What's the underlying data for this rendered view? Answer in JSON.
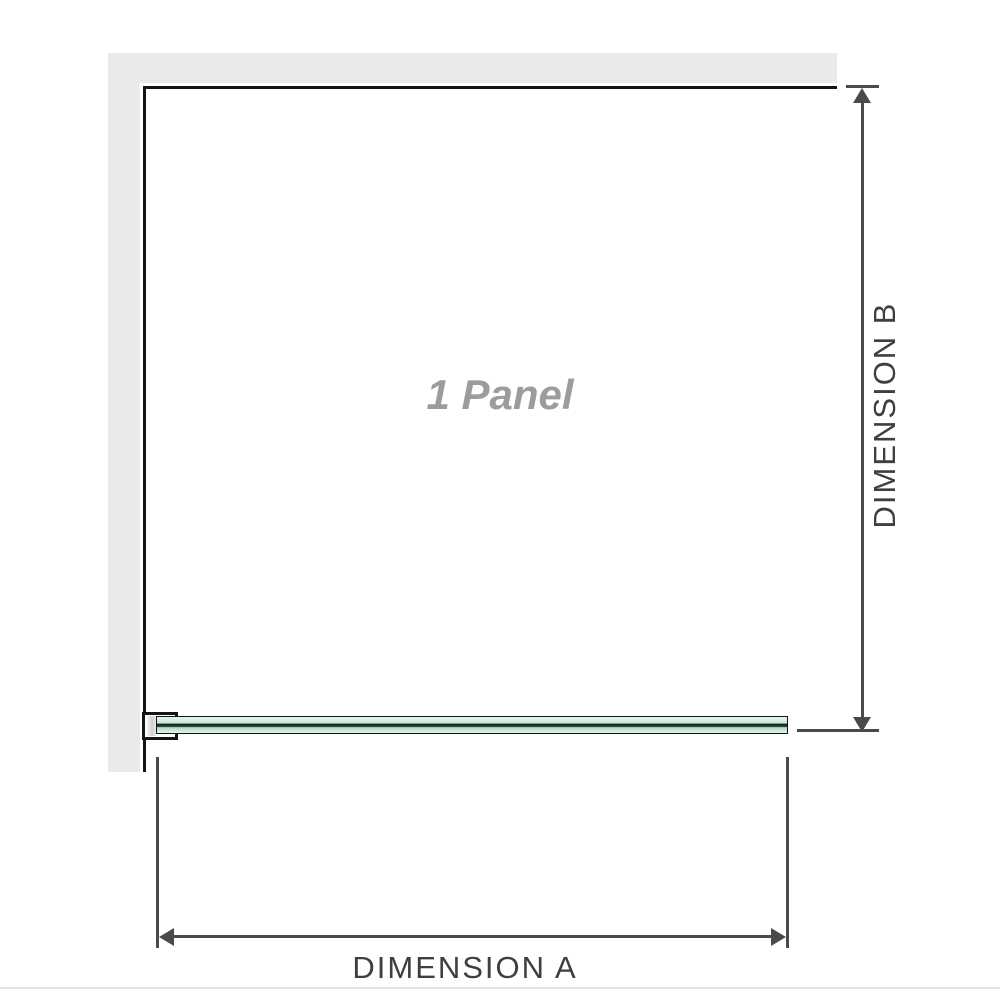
{
  "diagram": {
    "title": "shower screen single panel installation diagram (plan view)",
    "panel_label": "1 Panel",
    "dimension_a": {
      "label": "DIMENSION A",
      "orientation": "horizontal",
      "measures": "panel width"
    },
    "dimension_b": {
      "label": "DIMENSION B",
      "orientation": "vertical",
      "measures": "panel depth"
    },
    "colors": {
      "wall": "#eaeaea",
      "outline": "#141414",
      "dimension": "#4a4a4a",
      "text_dark": "#3f3f3f",
      "label_gray": "#9c9c9c",
      "glass_light": "#e4f4ec",
      "glass_mid": "#c7e9d6",
      "glass_core": "#1c2f25",
      "glass_deep": "#a9dcc2",
      "divider": "#e3e3e3"
    }
  }
}
